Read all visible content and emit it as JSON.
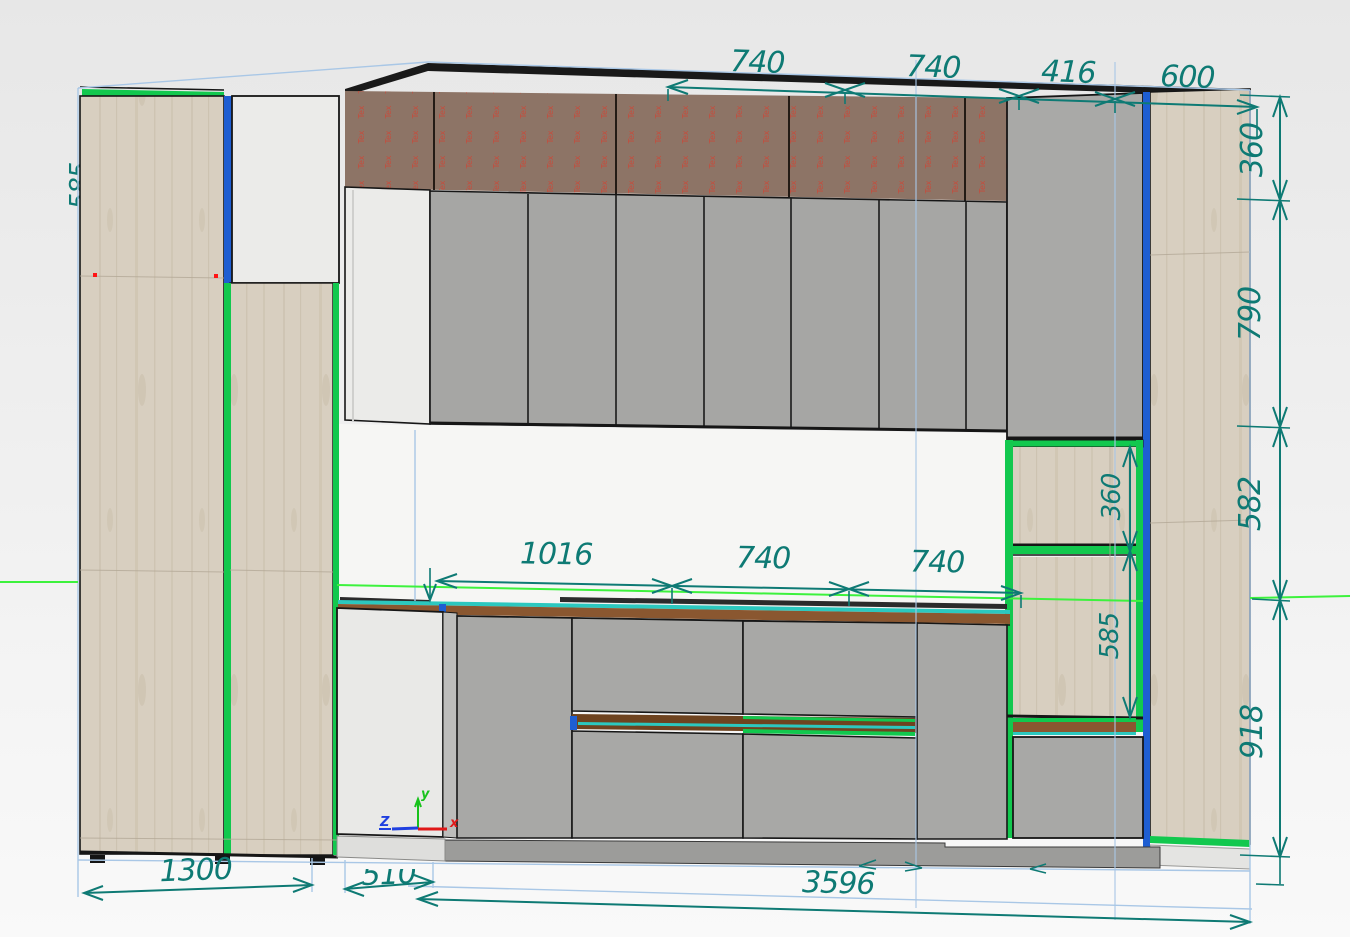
{
  "texture_placeholder": "Tex",
  "axis": {
    "x": "x",
    "y": "y",
    "z": "Z"
  },
  "dimensions": {
    "top": [
      "740",
      "740",
      "416",
      "600"
    ],
    "right": [
      "360",
      "790",
      "582",
      "918"
    ],
    "worktop": [
      "1016",
      "740",
      "740"
    ],
    "shelf": [
      "360",
      "585"
    ],
    "bottom": [
      "1300",
      "510",
      "3596"
    ],
    "left_edge_partial": "585"
  },
  "colors": {
    "dimension_teal": "#0e7a74",
    "construction_blue": "#a9c7e6",
    "level_line_green": "#3df23d",
    "edge_green": "#12c84e",
    "edge_blue": "#1e5ed2",
    "edge_cyan": "#2cc8bf",
    "worktop_brown": "#8a5730",
    "texture_red": "#cf4434",
    "wood": "#d8cfc0",
    "door_gray": "#a8a8a6",
    "door_white": "#ebebe9",
    "wall_band_brown": "#8d7466",
    "axis_x_red": "#e01818",
    "axis_y_green": "#18c21c",
    "axis_z_blue": "#2040e0"
  }
}
